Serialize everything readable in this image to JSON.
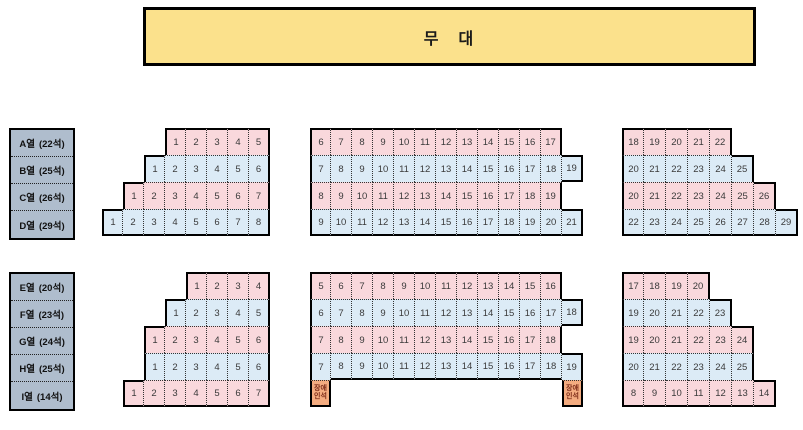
{
  "stage": {
    "label": "무　대"
  },
  "colors": {
    "pink": "#F9D8DC",
    "blue": "#DCEBF6",
    "disabled": "#F4AC80",
    "stage_fill": "#FBE18C",
    "legend_fill": "#AFBDCD"
  },
  "legend_top": {
    "rows": [
      {
        "name": "A열",
        "count": "(22석)"
      },
      {
        "name": "B열",
        "count": "(25석)"
      },
      {
        "name": "C열",
        "count": "(26석)"
      },
      {
        "name": "D열",
        "count": "(29석)"
      }
    ]
  },
  "legend_bottom": {
    "rows": [
      {
        "name": "E열",
        "count": "(20석)"
      },
      {
        "name": "F열",
        "count": "(23석)"
      },
      {
        "name": "G열",
        "count": "(24석)"
      },
      {
        "name": "H열",
        "count": "(25석)"
      },
      {
        "name": "I열",
        "count": "(14석)"
      }
    ]
  },
  "blocks": {
    "top_left": {
      "rows": [
        {
          "row": "A",
          "color": "pink",
          "offset": 3,
          "seats": [
            "1",
            "2",
            "3",
            "4",
            "5"
          ]
        },
        {
          "row": "B",
          "color": "blue",
          "offset": 2,
          "seats": [
            "1",
            "2",
            "3",
            "4",
            "5",
            "6"
          ]
        },
        {
          "row": "C",
          "color": "pink",
          "offset": 1,
          "seats": [
            "1",
            "2",
            "3",
            "4",
            "5",
            "6",
            "7"
          ]
        },
        {
          "row": "D",
          "color": "blue",
          "offset": 0,
          "seats": [
            "1",
            "2",
            "3",
            "4",
            "5",
            "6",
            "7",
            "8"
          ]
        }
      ]
    },
    "top_center": {
      "rows": [
        {
          "row": "A",
          "color": "pink",
          "offset": 0,
          "seats": [
            "6",
            "7",
            "8",
            "9",
            "10",
            "11",
            "12",
            "13",
            "14",
            "15",
            "16",
            "17"
          ]
        },
        {
          "row": "B",
          "color": "blue",
          "offset": 0,
          "seats": [
            "7",
            "8",
            "9",
            "10",
            "11",
            "12",
            "13",
            "14",
            "15",
            "16",
            "17",
            "18",
            "19"
          ]
        },
        {
          "row": "C",
          "color": "pink",
          "offset": 0,
          "seats": [
            "8",
            "9",
            "10",
            "11",
            "12",
            "13",
            "14",
            "15",
            "16",
            "17",
            "18",
            "19"
          ]
        },
        {
          "row": "D",
          "color": "blue",
          "offset": 0,
          "seats": [
            "9",
            "10",
            "11",
            "12",
            "13",
            "14",
            "15",
            "16",
            "17",
            "18",
            "19",
            "20",
            "21"
          ]
        }
      ]
    },
    "top_right": {
      "rows": [
        {
          "row": "A",
          "color": "pink",
          "offset": 0,
          "seats": [
            "18",
            "19",
            "20",
            "21",
            "22"
          ]
        },
        {
          "row": "B",
          "color": "blue",
          "offset": 0,
          "seats": [
            "20",
            "21",
            "22",
            "23",
            "24",
            "25"
          ]
        },
        {
          "row": "C",
          "color": "pink",
          "offset": 0,
          "seats": [
            "20",
            "21",
            "22",
            "23",
            "24",
            "25",
            "26"
          ]
        },
        {
          "row": "D",
          "color": "blue",
          "offset": 0,
          "seats": [
            "22",
            "23",
            "24",
            "25",
            "26",
            "27",
            "28",
            "29"
          ]
        }
      ]
    },
    "bottom_left": {
      "rows": [
        {
          "row": "E",
          "color": "pink",
          "offset": 3,
          "seats": [
            "1",
            "2",
            "3",
            "4"
          ]
        },
        {
          "row": "F",
          "color": "blue",
          "offset": 2,
          "seats": [
            "1",
            "2",
            "3",
            "4",
            "5"
          ]
        },
        {
          "row": "G",
          "color": "pink",
          "offset": 1,
          "seats": [
            "1",
            "2",
            "3",
            "4",
            "5",
            "6"
          ]
        },
        {
          "row": "H",
          "color": "blue",
          "offset": 1,
          "seats": [
            "1",
            "2",
            "3",
            "4",
            "5",
            "6"
          ]
        },
        {
          "row": "I",
          "color": "pink",
          "offset": 0,
          "seats": [
            "1",
            "2",
            "3",
            "4",
            "5",
            "6",
            "7"
          ]
        }
      ]
    },
    "bottom_center": {
      "rows": [
        {
          "row": "E",
          "color": "pink",
          "offset": 0,
          "seats": [
            "5",
            "6",
            "7",
            "8",
            "9",
            "10",
            "11",
            "12",
            "13",
            "14",
            "15",
            "16"
          ]
        },
        {
          "row": "F",
          "color": "blue",
          "offset": 0,
          "seats": [
            "6",
            "7",
            "8",
            "9",
            "10",
            "11",
            "12",
            "13",
            "14",
            "15",
            "16",
            "17",
            "18"
          ]
        },
        {
          "row": "G",
          "color": "pink",
          "offset": 0,
          "seats": [
            "7",
            "8",
            "9",
            "10",
            "11",
            "12",
            "13",
            "14",
            "15",
            "16",
            "17",
            "18"
          ]
        },
        {
          "row": "H",
          "color": "blue",
          "offset": 0,
          "seats": [
            "7",
            "8",
            "9",
            "10",
            "11",
            "12",
            "13",
            "14",
            "15",
            "16",
            "17",
            "18",
            "19"
          ]
        },
        {
          "row": "I",
          "color": "disabled",
          "cells": [
            {
              "col": 0,
              "label": "장애인석"
            },
            {
              "col": 12,
              "label": "장애인석"
            }
          ]
        }
      ]
    },
    "bottom_right": {
      "rows": [
        {
          "row": "E",
          "color": "pink",
          "offset": 0,
          "seats": [
            "17",
            "18",
            "19",
            "20"
          ]
        },
        {
          "row": "F",
          "color": "blue",
          "offset": 0,
          "seats": [
            "19",
            "20",
            "21",
            "22",
            "23"
          ]
        },
        {
          "row": "G",
          "color": "pink",
          "offset": 0,
          "seats": [
            "19",
            "20",
            "21",
            "22",
            "23",
            "24"
          ]
        },
        {
          "row": "H",
          "color": "blue",
          "offset": 0,
          "seats": [
            "20",
            "21",
            "22",
            "23",
            "24",
            "25"
          ]
        },
        {
          "row": "I",
          "color": "pink",
          "offset": 0,
          "seats": [
            "8",
            "9",
            "10",
            "11",
            "12",
            "13",
            "14"
          ]
        }
      ]
    }
  }
}
